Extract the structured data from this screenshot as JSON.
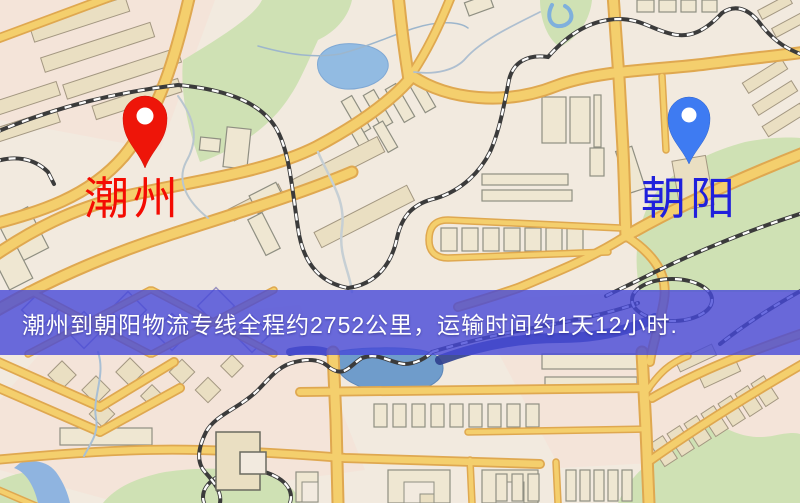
{
  "map": {
    "origin": {
      "label": "潮州",
      "pin_color": "#ee1509",
      "label_color": "#f40b02"
    },
    "destination": {
      "label": "朝阳",
      "pin_color": "#3e7bf2",
      "label_color": "#2020dc"
    },
    "colors": {
      "background": "#f2eadf",
      "road": "#f4cf6d",
      "road_casing": "#dfa850",
      "park": "#cfe1b4",
      "water": "#92bbe2",
      "river_dark": "#2f3f8e"
    }
  },
  "banner": {
    "text": "潮州到朝阳物流专线全程约2752公里，运输时间约1天12小时.",
    "background_color": "#4648d8",
    "text_color": "#ffffff"
  }
}
